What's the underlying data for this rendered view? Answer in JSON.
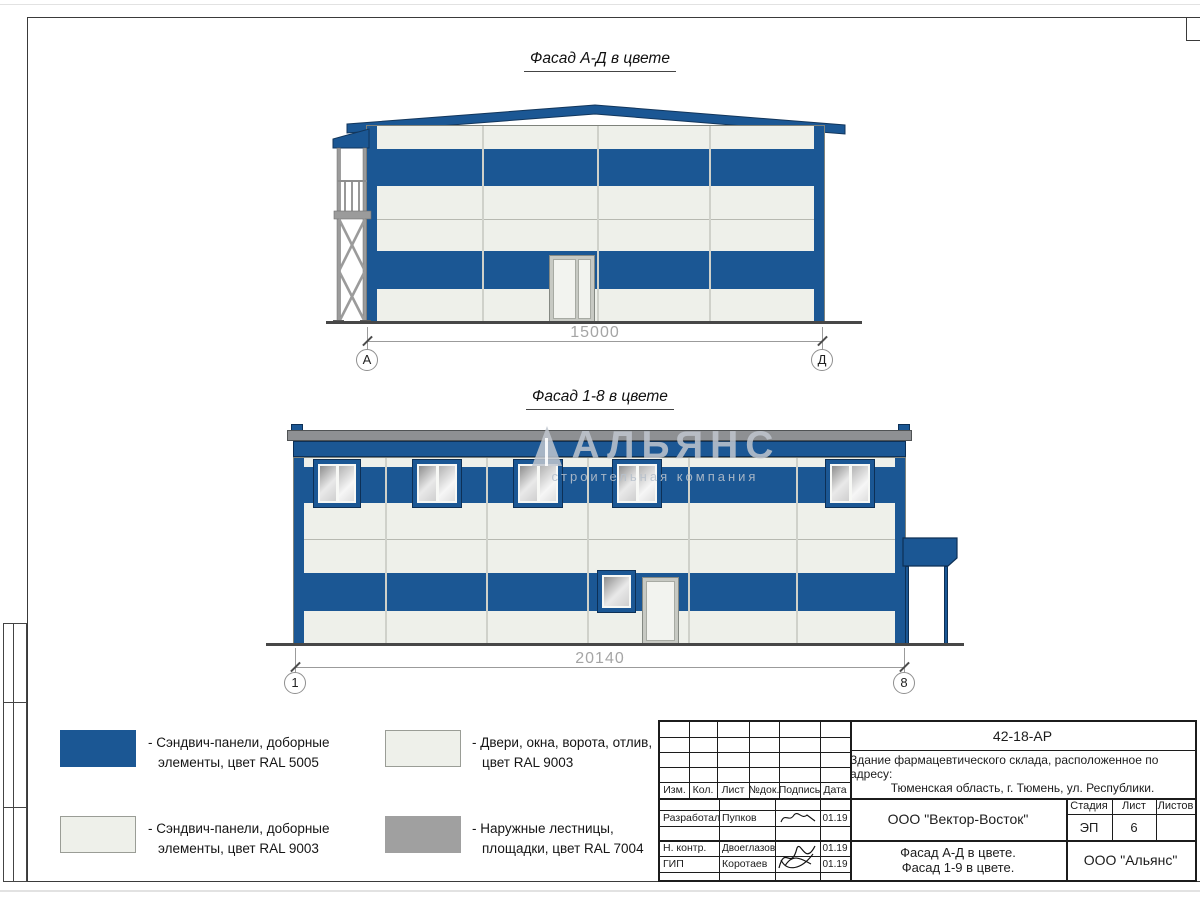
{
  "colors": {
    "ral5005": "#1b5794",
    "ral9003": "#eef0ea",
    "ral7004": "#a0a0a0"
  },
  "watermark": {
    "title": "АЛЬЯНС",
    "subtitle": "строительная компания"
  },
  "facade_ad": {
    "title": "Фасад А-Д в цвете",
    "dimension": "15000",
    "axis_left": "А",
    "axis_right": "Д"
  },
  "facade_18": {
    "title": "Фасад 1-8 в цвете",
    "dimension": "20140",
    "axis_left": "1",
    "axis_right": "8"
  },
  "legend": {
    "item1": "- Сэндвич-панели, доборные элементы, цвет RAL 5005",
    "item2": "- Сэндвич-панели, доборные элементы, цвет RAL 9003",
    "item3": "- Двери, окна, ворота, отлив, цвет RAL 9003",
    "item4": "- Наружные лестницы, площадки, цвет RAL 7004"
  },
  "titleblock": {
    "doc_number": "42-18-АР",
    "project_line1": "Здание фармацевтического склада, расположенное по адресу:",
    "project_line2": "Тюменская область, г. Тюмень, ул. Республики.",
    "headers": {
      "izm": "Изм.",
      "kol": "Кол.",
      "list": "Лист",
      "ndok": "№док.",
      "podpis": "Подпись",
      "data": "Дата"
    },
    "row_developed": {
      "role": "Разработал",
      "name": "Пупков",
      "date": "01.19"
    },
    "row_ncontr": {
      "role": "Н. контр.",
      "name": "Двоеглазов",
      "date": "01.19"
    },
    "row_gip": {
      "role": "ГИП",
      "name": "Коротаев",
      "date": "01.19"
    },
    "stage_header": "Стадия",
    "sheet_header": "Лист",
    "sheets_header": "Листов",
    "stage_value": "ЭП",
    "sheet_value": "6",
    "sheets_value": "",
    "org_contractor": "ООО \"Вектор-Восток\"",
    "drawing_title_line1": "Фасад А-Д в цвете.",
    "drawing_title_line2": "Фасад 1-9 в цвете.",
    "org_customer": "ООО \"Альянс\""
  }
}
